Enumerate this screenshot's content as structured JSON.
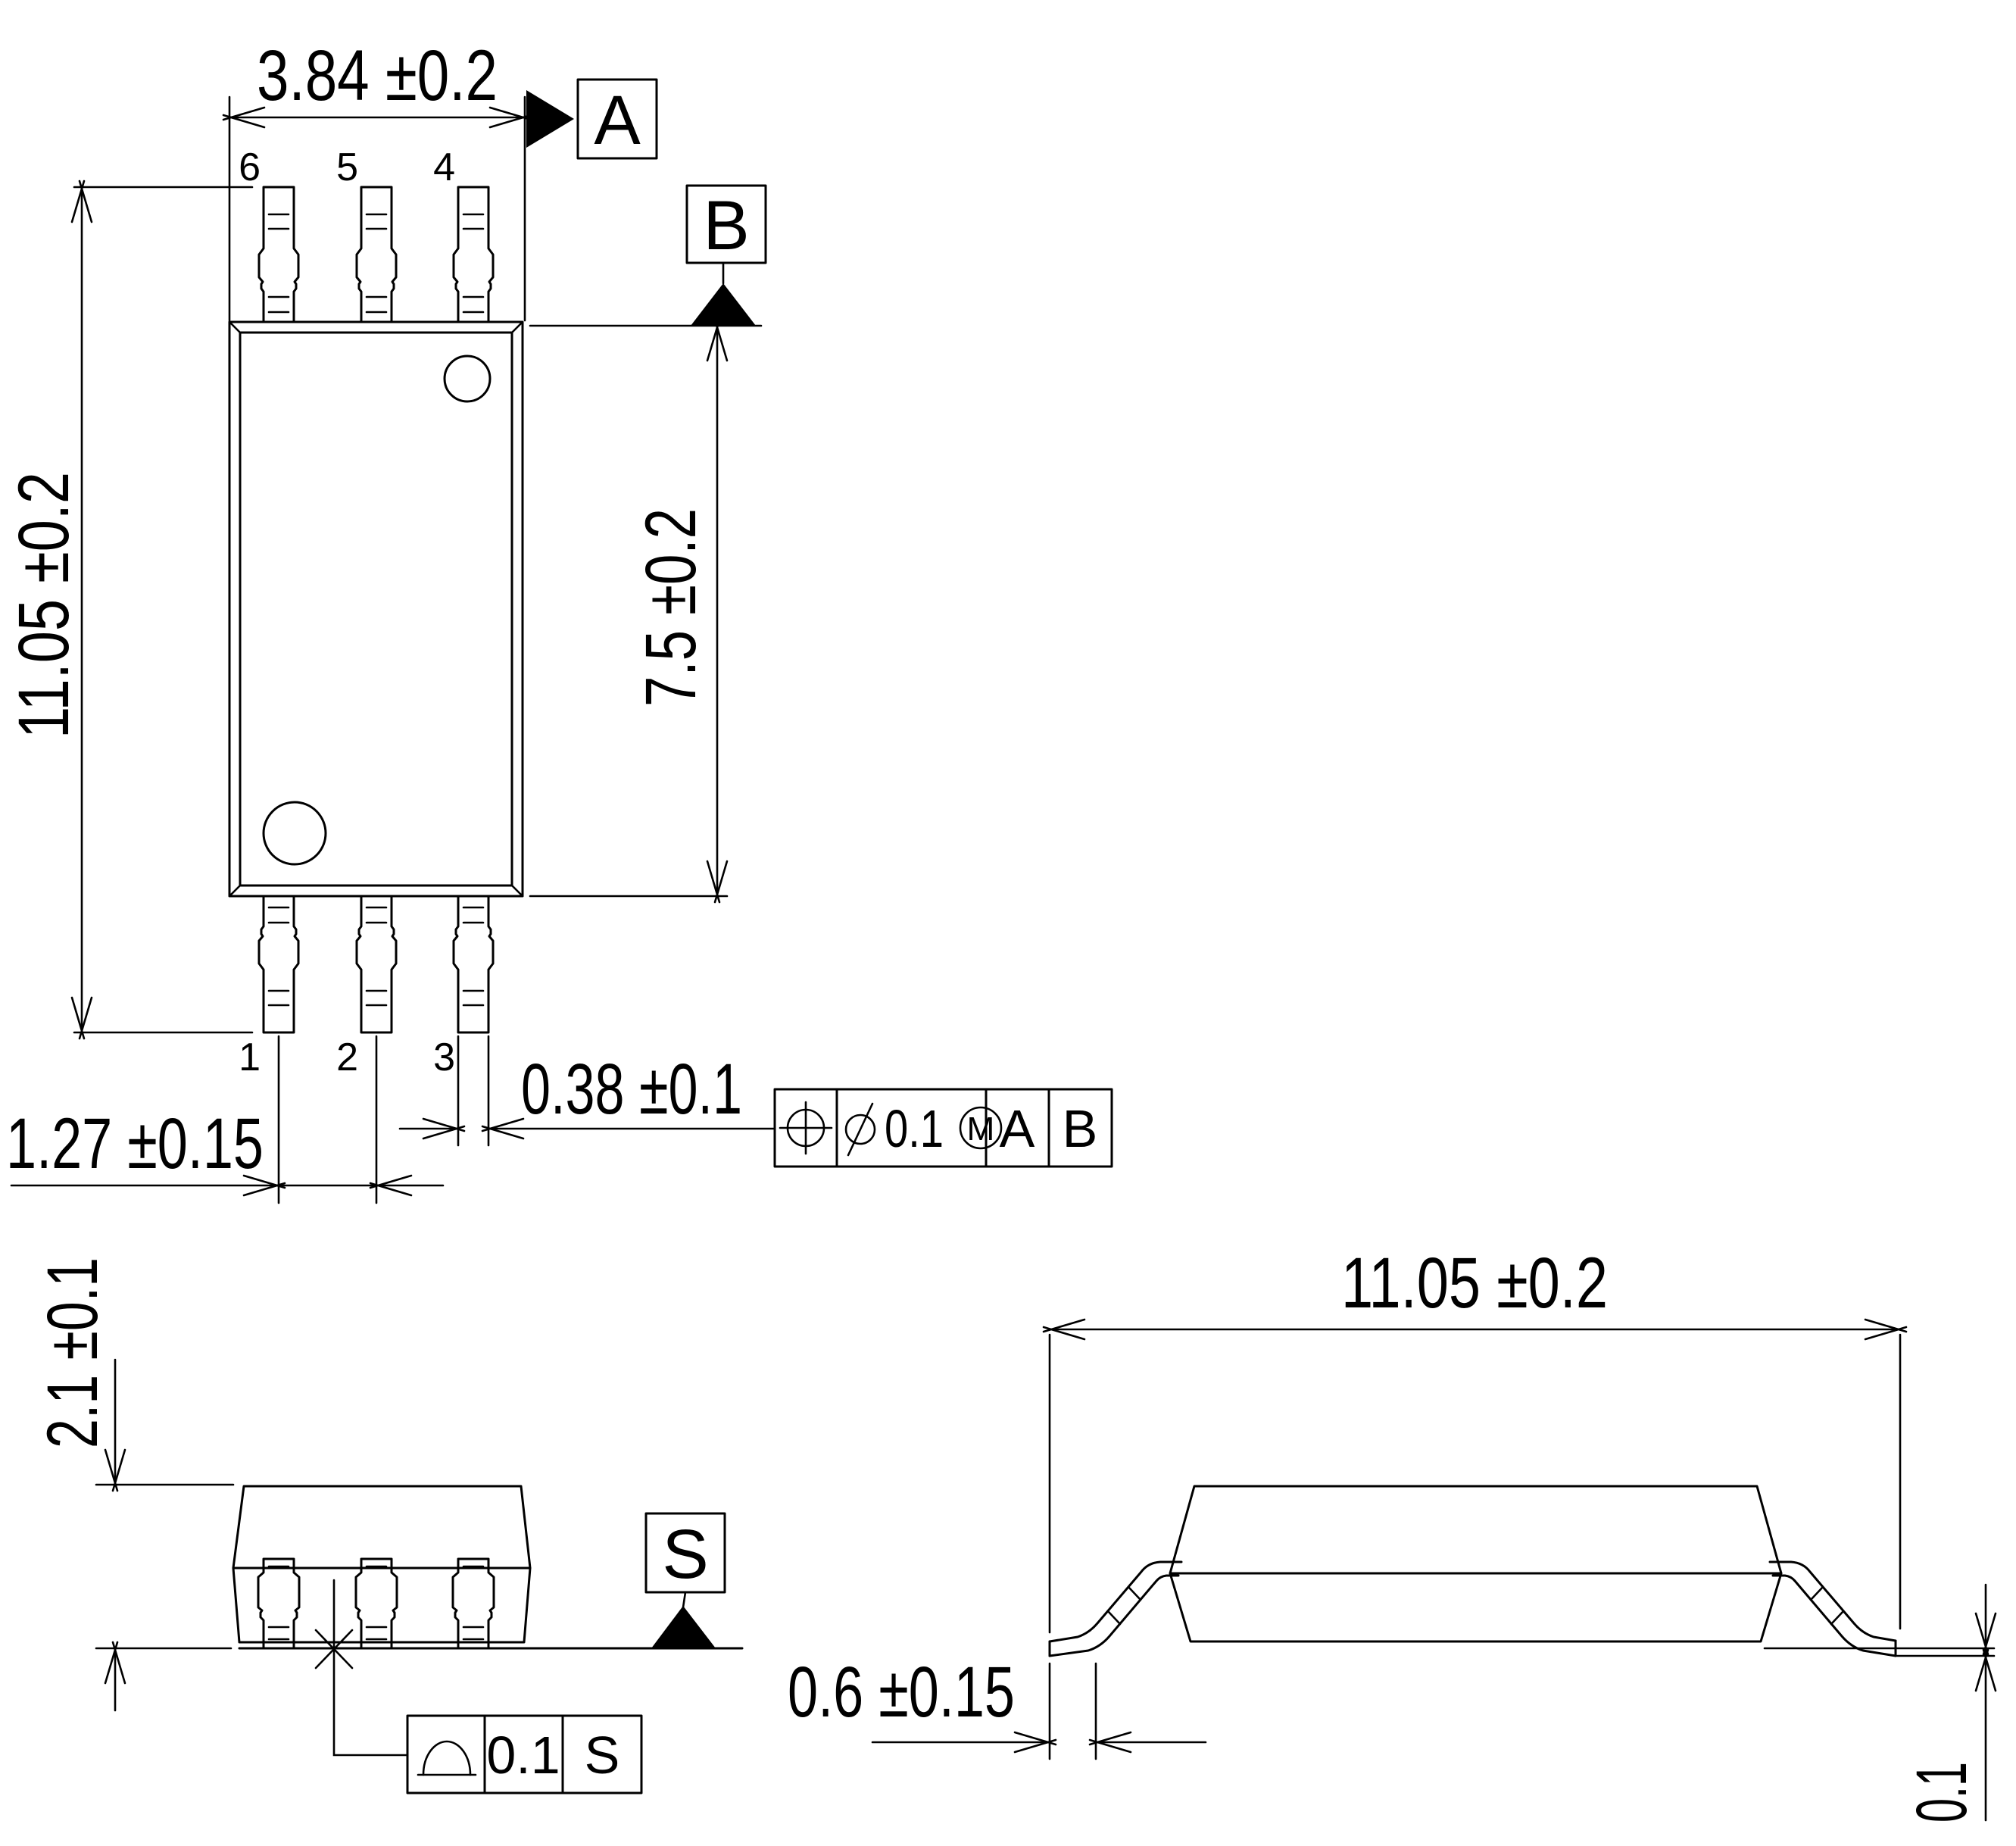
{
  "colors": {
    "background": "#ffffff",
    "line": "#000000"
  },
  "top_view": {
    "pin_numbers_top": [
      "6",
      "5",
      "4"
    ],
    "pin_numbers_bottom": [
      "1",
      "2",
      "3"
    ],
    "dim_width": "3.84 ±0.2",
    "dim_total_length": "11.05 ±0.2",
    "dim_body_length": "7.5 ±0.2",
    "dim_lead_width": "0.38 ±0.1",
    "dim_lead_pitch": "1.27 ±0.15",
    "datum_a": "A",
    "datum_b": "B",
    "position_fcf": {
      "tolerance": "0.1",
      "modifier": "M",
      "datum_primary": "A",
      "datum_secondary": "B"
    }
  },
  "front_view": {
    "dim_height": "2.1 ±0.1",
    "datum_s": "S",
    "seating_fcf": {
      "tolerance": "0.1",
      "datum": "S"
    }
  },
  "side_view": {
    "dim_total_length": "11.05 ±0.2",
    "dim_foot_length": "0.6 ±0.15",
    "dim_standoff": "0.1"
  }
}
